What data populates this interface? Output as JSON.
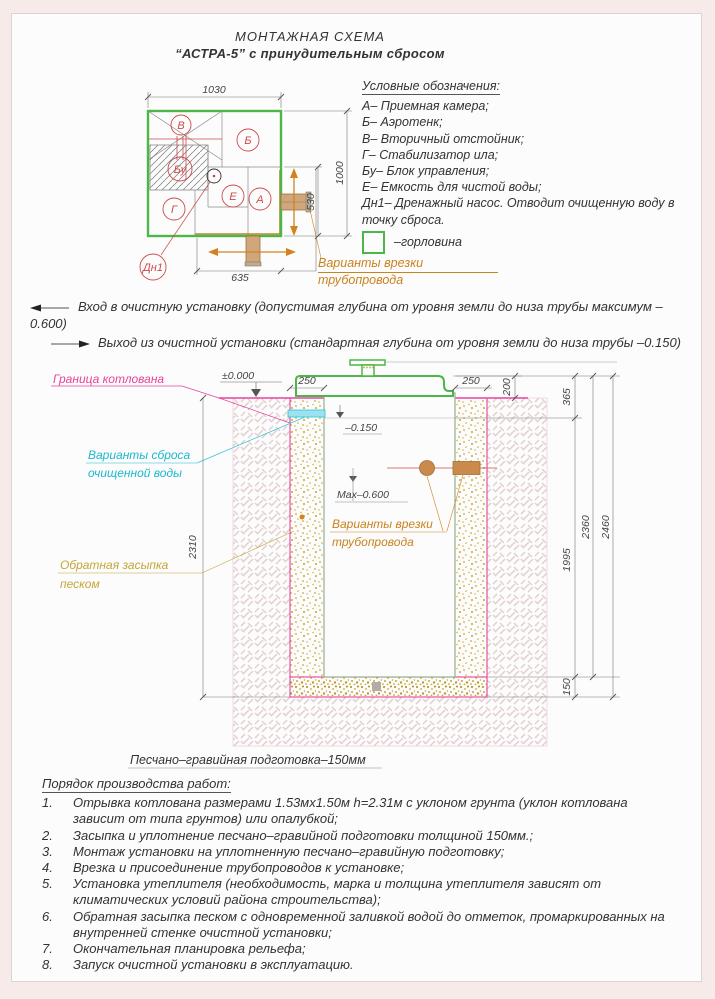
{
  "title": {
    "line1": "МОНТАЖНАЯ СХЕМА",
    "line2": "“АСТРА-5” с принудительным сбросом"
  },
  "plan": {
    "dims": {
      "width": "1030",
      "height": "1000",
      "pipe_side": "530",
      "pipe_bottom": "635"
    },
    "labels": {
      "v": "В",
      "b": "Б",
      "bu": "Бу",
      "g": "Г",
      "e": "Е",
      "a": "А",
      "dn1": "Дн1"
    },
    "pipe_note_line1": "Варианты врезки",
    "pipe_note_line2": "трубопровода"
  },
  "legend": {
    "title": "Условные обозначения:",
    "items": [
      "А– Приемная камера;",
      "Б– Аэротенк;",
      "В– Вторичный отстойник;",
      "Г– Стабилизатор ила;",
      "Бу– Блок управления;",
      "Е– Емкость для чистой воды;",
      "Дн1– Дренажный насос. Отводит очищенную воду в точку сброса."
    ],
    "gorlovina_label": "–горловина"
  },
  "notes": {
    "inlet": "Вход в очистную установку (допустимая глубина от уровня земли до низа трубы максимум –0.600)",
    "outlet": "Выход из очистной установки (стандартная глубина от уровня земли до низа трубы –0.150)"
  },
  "section": {
    "pit_boundary": "Граница котлована",
    "zero_level": "±0.000",
    "level_150": "–0.150",
    "max_600": "Max–0.600",
    "discharge_line1": "Варианты сброса",
    "discharge_line2": "очищенной воды",
    "backfill_line1": "Обратная засыпка",
    "backfill_line2": "песком",
    "pipe_note_line1": "Варианты врезки",
    "pipe_note_line2": "трубопровода",
    "bed_label": "Песчано–гравийная подготовка–150мм",
    "dims": {
      "d250l": "250",
      "d250r": "250",
      "d200": "200",
      "d365": "365",
      "d2310": "2310",
      "d1995": "1995",
      "d2360": "2360",
      "d2460": "2460",
      "d150": "150"
    }
  },
  "procedure": {
    "title": "Порядок производства работ:",
    "items": [
      {
        "num": "1.",
        "text": "Отрывка котлована размерами 1.53мх1.50м h=2.31м с уклоном грунта (уклон котлована зависит от типа грунтов) или опалубкой;"
      },
      {
        "num": "2.",
        "text": "Засыпка и уплотнение песчано–гравийной подготовки толщиной 150мм.;"
      },
      {
        "num": "3.",
        "text": "Монтаж установки на уплотненную песчано–гравийную подготовку;"
      },
      {
        "num": "4.",
        "text": "Врезка и присоединение трубопроводов к установке;"
      },
      {
        "num": "5.",
        "text": "Установка утеплителя (необходимость, марка и толщина утеплителя зависят от климатических условий района строительства);"
      },
      {
        "num": "6.",
        "text": "Обратная засыпка песком с одновременной заливкой водой до отметок, промаркированных на внутренней стенке очистной установки;"
      },
      {
        "num": "7.",
        "text": "Окончательная планировка рельефа;"
      },
      {
        "num": "8.",
        "text": "Запуск очистной установки в эксплуатацию."
      }
    ]
  },
  "colors": {
    "green": "#4cb648",
    "red": "#cc4a4a",
    "orange": "#d2821e",
    "orange_text": "#c8821e",
    "magenta": "#e8439c",
    "cyan": "#1ab8cc",
    "olive": "#c3a536",
    "sand": "#c9a62e",
    "dim": "#555555"
  }
}
